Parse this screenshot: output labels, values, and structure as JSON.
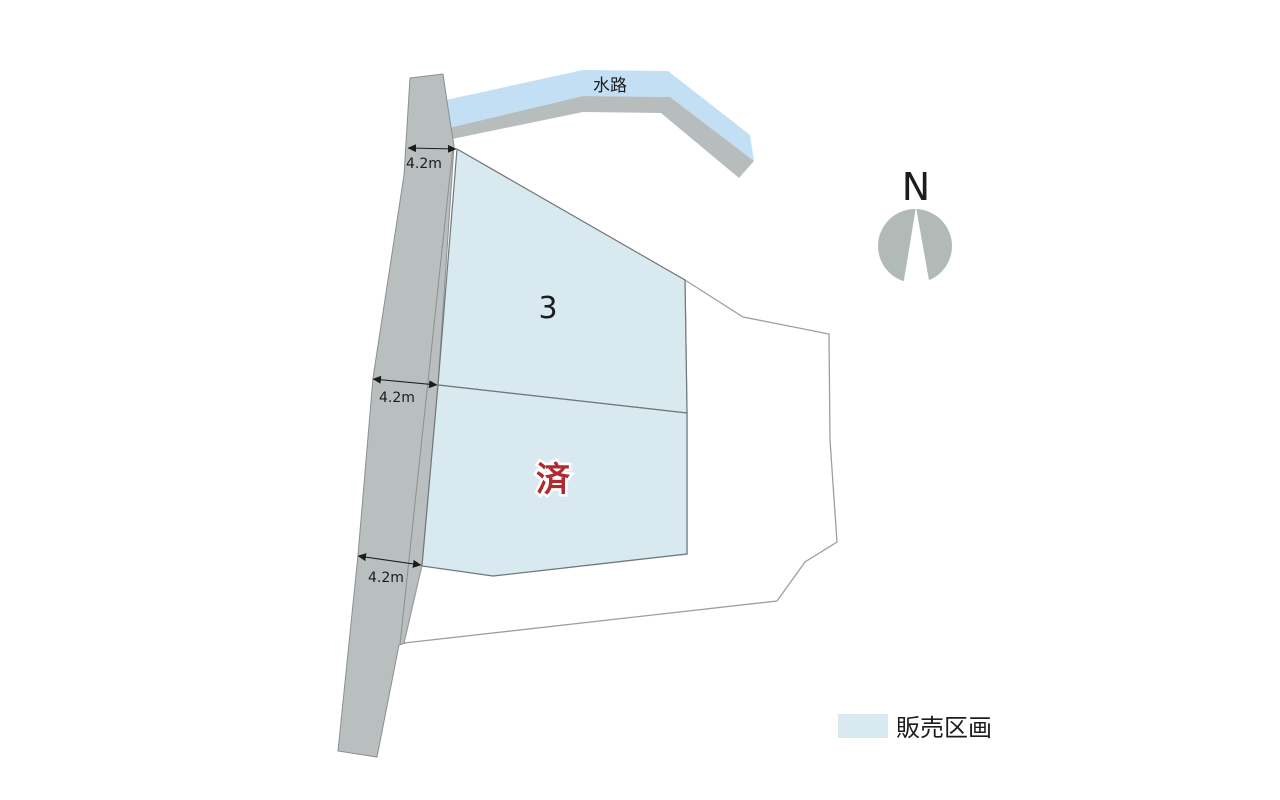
{
  "diagram": {
    "type": "real-estate-lot-map",
    "waterway_label": "水路",
    "compass_label": "N",
    "lots": {
      "lot3_label": "3",
      "sold_label": "済"
    },
    "dimensions": {
      "top": "4.2m",
      "middle": "4.2m",
      "bottom": "4.2m"
    },
    "legend": {
      "label": "販売区画"
    }
  },
  "colors": {
    "background": "#ffffff",
    "road": "#b9bebe",
    "road_outline": "#8a9090",
    "waterway": "#c2dff4",
    "bank": "#b7bdbd",
    "parcel_fill": "#d8eaf0",
    "parcel_stroke": "#6f7779",
    "neighbor_stroke": "#9aa0a2",
    "sold_text": "#b02a30",
    "compass": "#b2bab7",
    "text": "#1c1c1c"
  }
}
